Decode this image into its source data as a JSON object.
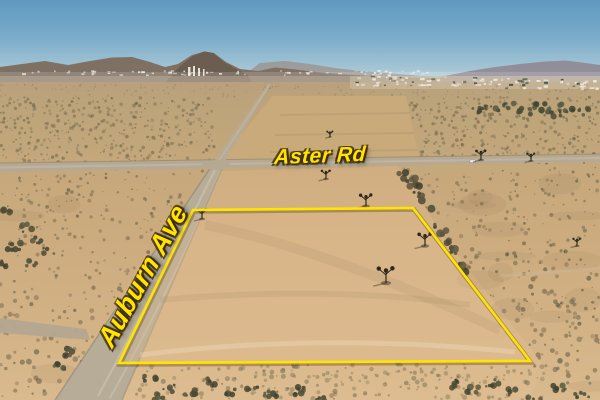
{
  "annotations": {
    "road_labels": [
      {
        "id": "aster-rd",
        "text": "Aster Rd",
        "orientation_deg": -2
      },
      {
        "id": "auburn-ave",
        "text": "Auburn Ave",
        "orientation_deg": -61
      }
    ],
    "parcel_outline": {
      "shape": "quadrilateral",
      "points": [
        [
          193,
          210
        ],
        [
          413,
          208
        ],
        [
          530,
          361
        ],
        [
          119,
          363
        ]
      ],
      "stroke_color": "#FFE400"
    }
  },
  "palette": {
    "annotation_yellow": "#FFE400",
    "label_outline": "#3E2A02",
    "sky_top": "#5F98C0",
    "sky_horizon": "#C9DADE",
    "mountain_near": "#6A5C4F",
    "mountain_far": "#8F8893",
    "desert_far": "#B7A07C",
    "desert_near": "#D9BA8E",
    "cleared_lot": "#C9AA7B",
    "road": "#B5A994",
    "scrub_dark": "#5E5C42",
    "distant_town_white": "#F2EFE6"
  }
}
